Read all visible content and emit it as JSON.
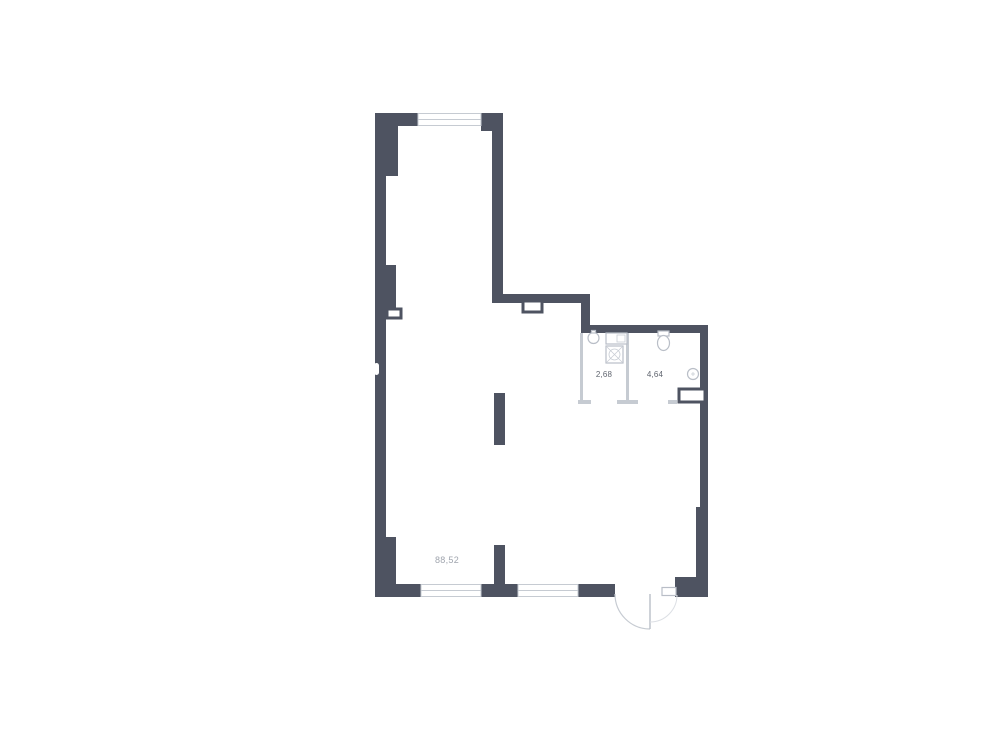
{
  "colors": {
    "background": "#ffffff",
    "wall": "#4e5361",
    "partition": "#c6cbd2",
    "fixture_outline": "#b9bec7",
    "area_label_text": "#a0a5ae",
    "room_label_text": "#60656f"
  },
  "floor_plan": {
    "main_room": {
      "area": "88,52"
    },
    "bathroom": {
      "area": "2,68"
    },
    "wc": {
      "area": "4,64"
    },
    "fixtures": [
      "washbasin",
      "sink-counter",
      "washing-machine",
      "toilet",
      "riser",
      "vent-shaft",
      "wall-niche",
      "entrance-door"
    ],
    "windows_count": 3
  }
}
